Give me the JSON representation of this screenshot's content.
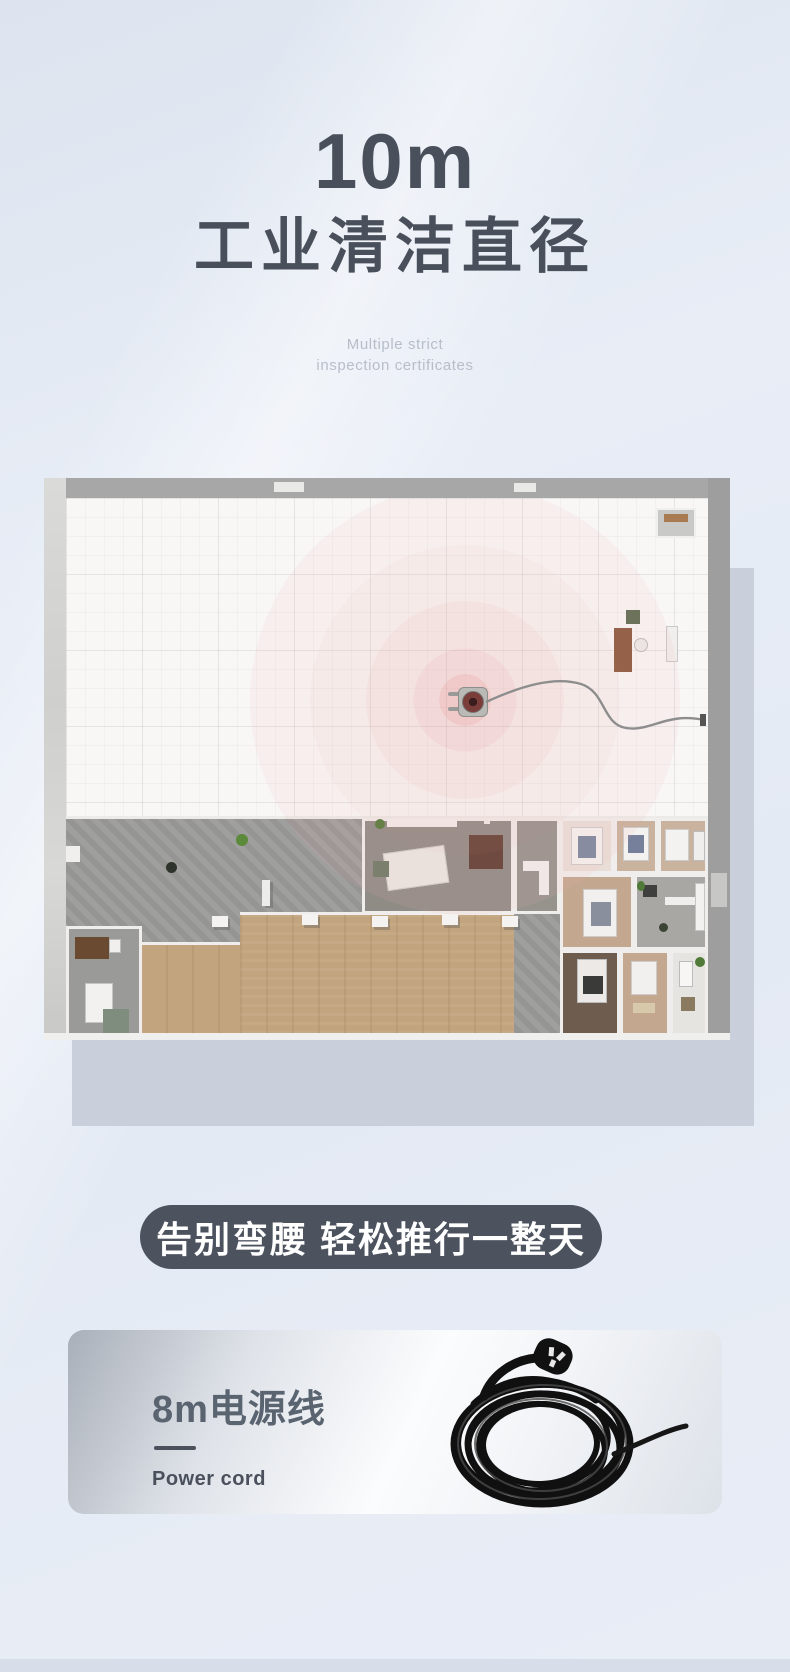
{
  "page": {
    "background_color": "#e8edf6",
    "bottom_strip_color": "#d7deea"
  },
  "hero": {
    "headline_value": "10m",
    "headline_label": "工业清洁直径",
    "subtitle_line1": "Multiple strict",
    "subtitle_line2": "inspection certificates",
    "text_color": "#4a505b",
    "subtitle_color": "#b7bec9"
  },
  "floorplan": {
    "illustration": "top-down-3d-floorplan-with-cleaning-radius",
    "ring_color": "#e79494",
    "machine": "floor-scrubber-with-power-cord"
  },
  "banner": {
    "label": "告别弯腰 轻松推行一整天",
    "background_color": "#4c535f",
    "text_color": "#ffffff"
  },
  "feature_card": {
    "title": "8m电源线",
    "subtitle": "Power cord",
    "illustration": "coiled-power-cord-with-plug"
  }
}
